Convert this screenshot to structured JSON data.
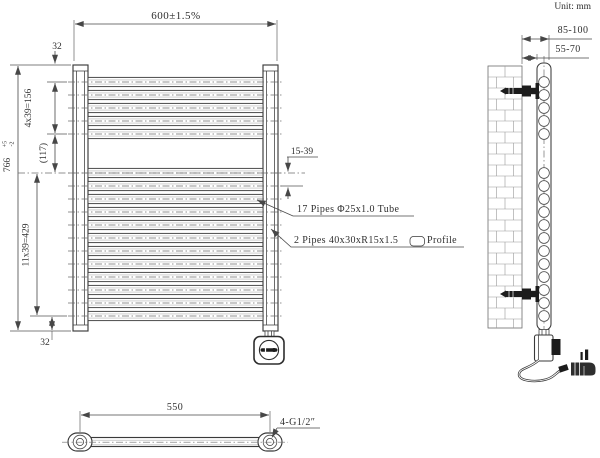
{
  "unit": {
    "label": "Unit: mm"
  },
  "front": {
    "dim_width": "600±1.5%",
    "dim_top_offset": "32",
    "dim_top_group": "4x39=156",
    "dim_gap": "(117)",
    "dim_height": "766",
    "tol_plus": "+5",
    "tol_minus": "-2",
    "dim_bottom_group": "11x39=429",
    "dim_bottom_offset": "32",
    "dim_spacing": "15-39",
    "note_tubes": "17 Pipes Φ25x1.0 Tube",
    "note_profile": "2 Pipes 40x30xR15x1.5",
    "note_profile_suffix": "Profile",
    "pipes_top": 5,
    "pipes_bottom": 12
  },
  "side": {
    "dim_wall_to_outer": "85-100",
    "dim_wall_to_inner": "55-70"
  },
  "bottom": {
    "dim_span": "550",
    "note_thread": "4-G1/2″"
  },
  "colors": {
    "line": "#474747",
    "text": "#2f2f2f",
    "fill_dark": "#1c1c1c"
  }
}
